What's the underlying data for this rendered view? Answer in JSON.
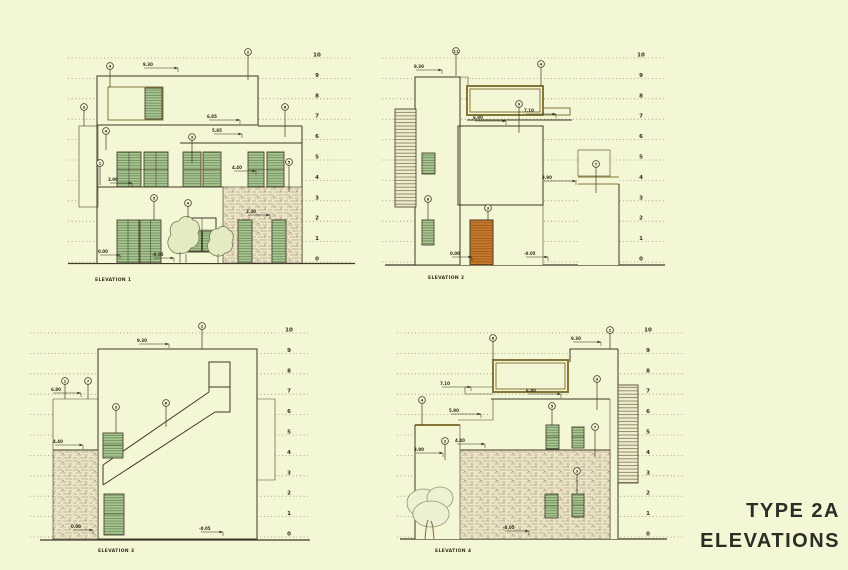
{
  "page": {
    "background": "#f4f7d6",
    "title_line1": "TYPE 2A",
    "title_line2": "ELEVATIONS"
  },
  "colors": {
    "paper": "#f4f7d6",
    "line": "#3e3827",
    "dash": "#95926e",
    "shutter_green": "#abc893",
    "frame_brown": "#867637",
    "door_orange": "#c57a2c",
    "stone": "#ece6c9"
  },
  "levels": [
    "0",
    "1",
    "2",
    "3",
    "4",
    "5",
    "6",
    "7",
    "8",
    "9",
    "10"
  ],
  "elevations": [
    {
      "label": "ELEVATION 1",
      "dims": [
        "9.30",
        "6.85",
        "5.85",
        "4.40",
        "3.90",
        "2.30",
        "0.00",
        "-0.05"
      ],
      "callouts": [
        "4",
        "2",
        "3",
        "6",
        "4",
        "1",
        "3",
        "5",
        "5",
        "4"
      ]
    },
    {
      "label": "ELEVATION 2",
      "dims": [
        "9.30",
        "7.10",
        "6.80",
        "3.90",
        "0.00",
        "-0.05"
      ],
      "callouts": [
        "11",
        "4",
        "9",
        "7",
        "8",
        "3"
      ]
    },
    {
      "label": "ELEVATION 3",
      "dims": [
        "9.30",
        "6.80",
        "4.40",
        "0.00",
        "-0.05"
      ],
      "callouts": [
        "2",
        "1",
        "7",
        "3",
        "6"
      ]
    },
    {
      "label": "ELEVATION 4",
      "dims": [
        "9.30",
        "7.10",
        "6.80",
        "5.90",
        "4.40",
        "3.90",
        "-0.05"
      ],
      "callouts": [
        "6",
        "2",
        "9",
        "4",
        "5",
        "7",
        "2",
        "3"
      ]
    }
  ]
}
